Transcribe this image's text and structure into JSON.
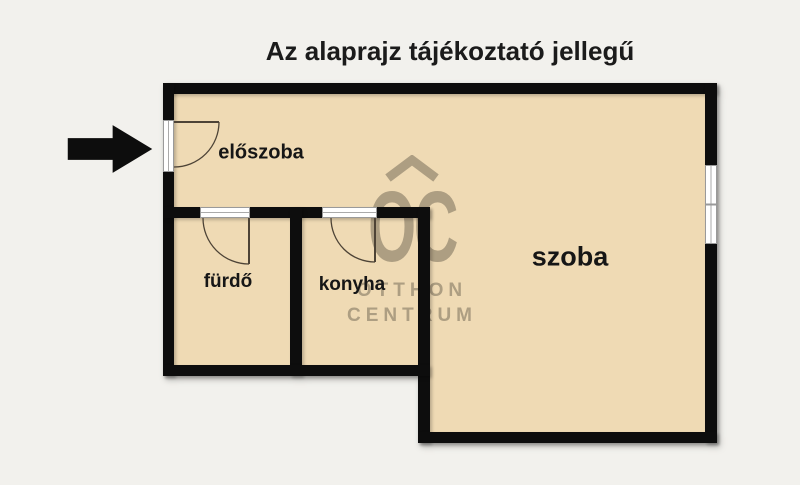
{
  "title": "Az alaprajz tájékoztató jellegű",
  "rooms": {
    "eloszoba": {
      "label": "előszoba"
    },
    "furdo": {
      "label": "fürdő"
    },
    "konyha": {
      "label": "konyha"
    },
    "szoba": {
      "label": "szoba"
    }
  },
  "watermark": {
    "logo": "OC",
    "name_line1": "OTTHON",
    "name_line2": "CENTRUM"
  },
  "icons": {
    "entrance_arrow": "solid black right-pointing arrow marking the entrance door",
    "roof_chevron": "roof-shaped chevron above OC logo"
  },
  "colors": {
    "background": "#f2f1ed",
    "room_fill": "#efdab4",
    "wall": "#0d0d0d",
    "watermark": "#ac9f88",
    "title_text": "#1b1b1b"
  }
}
